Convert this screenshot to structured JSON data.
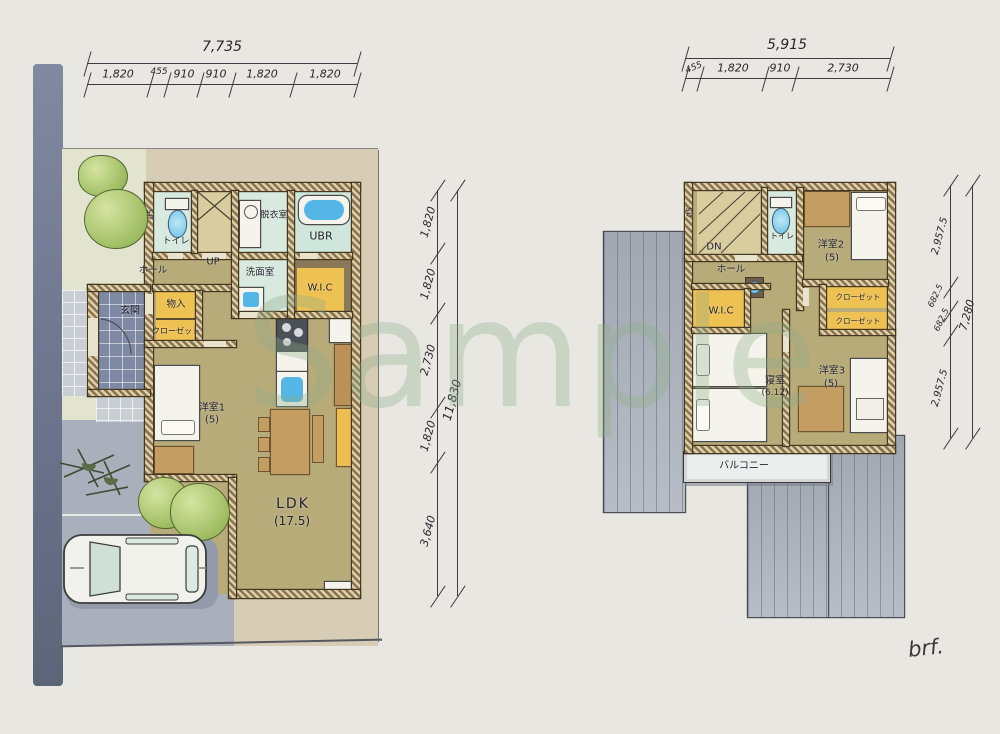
{
  "watermark": {
    "text": "Sample"
  },
  "signature": {
    "text": "brf."
  },
  "palette": {
    "wall_brown": "#8a7550",
    "floor_tan": "#b7ab7a",
    "wet_cyan": "#d8e9e0",
    "closet_orange": "#eec153",
    "water_blue": "#54b6e6",
    "roof_gray": "#b9bfc7",
    "road_blue": "#6f7890",
    "tree_green": "#a5c269",
    "watermark_green": "#8fae88"
  },
  "plan1": {
    "dim_top": {
      "total": "7,735",
      "segments": [
        "1,820",
        "455",
        "910",
        "910",
        "1,820",
        "1,820"
      ]
    },
    "dim_right": {
      "total": "11,830",
      "segments": [
        "1,820",
        "1,820",
        "2,730",
        "1,820",
        "3,640"
      ]
    },
    "labels": {
      "toilet": "トイレ",
      "window": "05",
      "up": "UP",
      "dressing": "脱衣室",
      "bath": "UBR",
      "washroom": "洗面室",
      "wic": "W.I.C",
      "hall": "ホール",
      "storage": "物入",
      "closet": "クローゼット",
      "entrance": "玄関",
      "room1": "洋室1",
      "room1_size": "(5)",
      "ldk": "LDK",
      "ldk_size": "(17.5)"
    }
  },
  "plan2": {
    "dim_top": {
      "total": "5,915",
      "segments": [
        "455",
        "1,820",
        "910",
        "2,730"
      ]
    },
    "dim_right": {
      "total": "7,280",
      "segments": [
        "2,957.5",
        "682.5",
        "682.5",
        "2,957.5"
      ]
    },
    "labels": {
      "window": "05",
      "dn": "DN",
      "toilet": "トイレ",
      "room2": "洋室2",
      "room2_size": "(5)",
      "hall": "ホール",
      "wic": "W.I.C",
      "closet1": "クローゼット",
      "closet2": "クローゼット",
      "bedroom": "寝室",
      "bedroom_size": "(6.12)",
      "room3": "洋室3",
      "room3_size": "(5)",
      "balcony": "バルコニー"
    }
  }
}
